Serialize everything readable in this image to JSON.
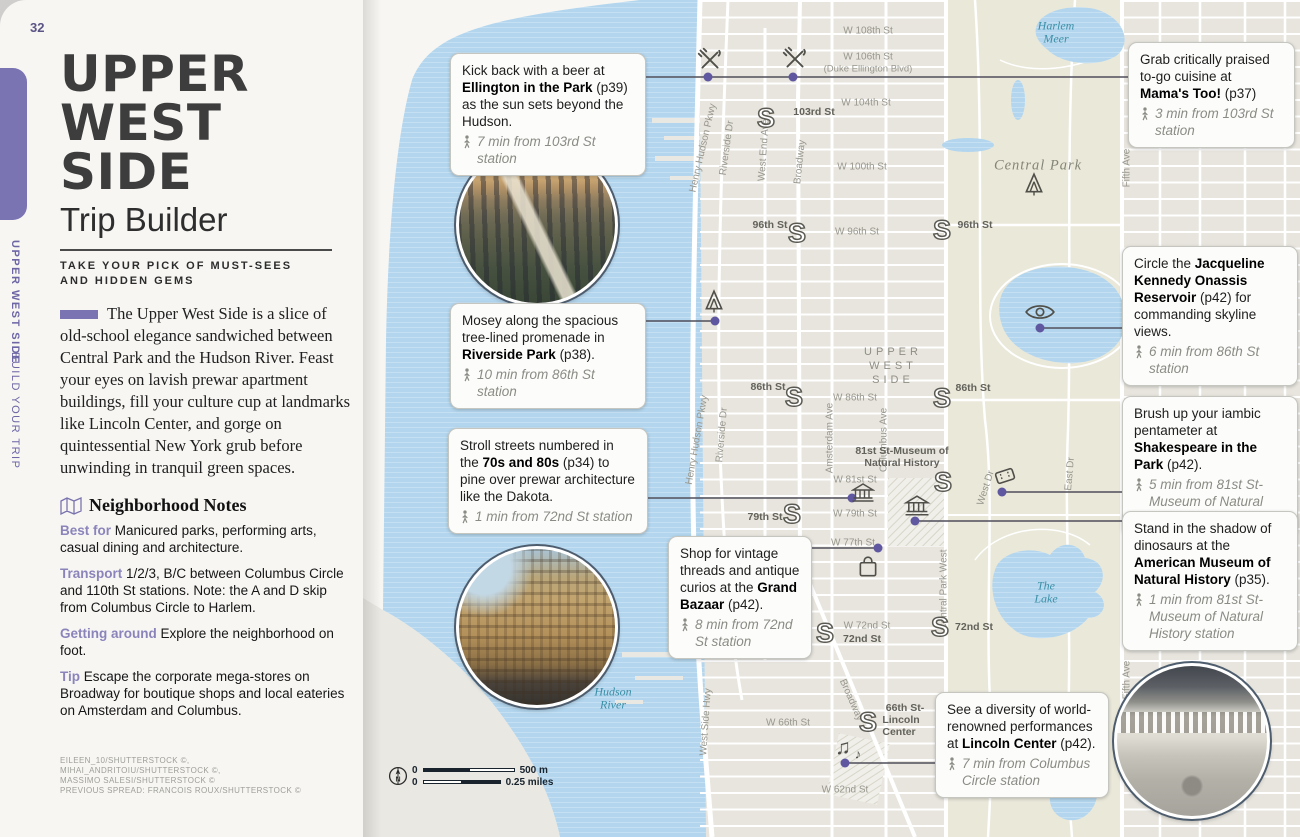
{
  "colors": {
    "accent": "#7b74b3",
    "accent_dark": "#5f58a0",
    "water": "#b3d6ee",
    "land": "#e7e5dd",
    "park": "#eae8d9",
    "teal": "#3b8fa6"
  },
  "icons": {
    "subway": "S",
    "music_note": "♫",
    "music_note_small": "♪",
    "compass_north": "N",
    "restaurant": "crossed-fork-knife",
    "park": "tree",
    "viewpoint": "eye",
    "museum": "classical-building",
    "theater": "ticket",
    "shopping": "bag",
    "walk": "walking-person",
    "notes": "folded-map"
  },
  "page": {
    "number": "32",
    "tab_line1": "UPPER WEST SIDE",
    "tab_line2": "BUILD YOUR TRIP"
  },
  "header": {
    "t1": "UPPER",
    "t2": "WEST",
    "t3": "SIDE",
    "subtitle": "Trip Builder",
    "kicker_l1": "TAKE YOUR PICK OF MUST-SEES",
    "kicker_l2": "AND HIDDEN GEMS"
  },
  "intro": "The Upper West Side is a slice of old-school elegance sandwiched between Central Park and the Hudson River. Feast your eyes on lavish prewar apartment buildings, fill your culture cup at landmarks like Lincoln Center, and gorge on quintessential New York grub before unwinding in tranquil green spaces.",
  "notes": {
    "heading": "Neighborhood Notes",
    "items": [
      {
        "label": "Best for",
        "text": "Manicured parks, performing arts, casual dining and architecture."
      },
      {
        "label": "Transport",
        "text": "1/2/3, B/C between Columbus Circle and 110th St stations. Note: the A and D skip from Columbus Circle to Harlem."
      },
      {
        "label": "Getting around",
        "text": "Explore the neighborhood on foot."
      },
      {
        "label": "Tip",
        "text": "Escape the corporate mega-stores on Broadway for boutique shops and local eateries on Amsterdam and Columbus."
      }
    ]
  },
  "credits": {
    "l1": "EILEEN_10/SHUTTERSTOCK ©, MIHAI_ANDRITOIU/SHUTTERSTOCK ©,",
    "l2": "MASSIMO SALESI/SHUTTERSTOCK ©",
    "l3": "PREVIOUS SPREAD: FRANCOIS ROUX/SHUTTERSTOCK ©"
  },
  "callouts": {
    "ellington": {
      "pre": "Kick back with a beer at ",
      "bold": "Ellington in the Park",
      "post": " (p39) as the sun sets beyond the Hudson.",
      "time": "7 min from 103rd St station"
    },
    "mamas": {
      "pre": "Grab critically praised to-go cuisine at ",
      "bold": "Mama's Too!",
      "post": " (p37)",
      "time": "3 min from 103rd St station"
    },
    "riverside": {
      "pre": "Mosey along the spacious tree-lined promenade in ",
      "bold": "Riverside Park",
      "post": " (p38).",
      "time": "10 min from 86th St station"
    },
    "seventies": {
      "pre": "Stroll streets numbered in the ",
      "bold": "70s and 80s",
      "post": " (p34) to pine over prewar architecture like the Dakota.",
      "time": "1 min from 72nd St station"
    },
    "bazaar": {
      "pre": "Shop for vintage threads and antique curios at the ",
      "bold": "Grand Bazaar",
      "post": " (p42).",
      "time": "8 min from 72nd St station"
    },
    "reservoir": {
      "pre": "Circle the ",
      "bold": "Jacqueline Kennedy Onassis Reservoir",
      "post": " (p42) for commanding skyline views.",
      "time": "6 min from 86th St station"
    },
    "shakespeare": {
      "pre": "Brush up your iambic pentameter at ",
      "bold": "Shakespeare in the Park",
      "post": " (p42).",
      "time": "5 min from 81st St-Museum of Natural History station"
    },
    "amnh": {
      "pre": "Stand in the shadow of dinosaurs at the ",
      "bold": "American Museum of Natural History",
      "post": " (p35).",
      "time": "1 min from 81st St-Museum of Natural History station"
    },
    "lincoln": {
      "pre": "See a diversity of world-renowned performances at ",
      "bold": "Lincoln Center",
      "post": " (p42).",
      "time": "7 min from Columbus Circle station"
    }
  },
  "map": {
    "streets": {
      "w108": "W 108th St",
      "w106": "W 106th St",
      "w106b": "(Duke Ellington Blvd)",
      "w104": "W 104th St",
      "w100": "W 100th St",
      "w96": "W 96th St",
      "w86": "W 86th St",
      "w81": "W 81st St",
      "w79": "W 79th St",
      "w77": "W 77th St",
      "w72": "W 72nd St",
      "w66": "W 66th St",
      "w62": "W 62nd St"
    },
    "avenues": {
      "henry_hudson": "Henry Hudson Pkwy",
      "riverside_dr": "Riverside Dr",
      "west_end": "West End Ave",
      "broadway": "Broadway",
      "amsterdam": "Amsterdam Ave",
      "columbus": "Columbus Ave",
      "cpw": "Central Park West",
      "west_dr": "West Dr",
      "east_dr": "East Dr",
      "fifth": "Fifth Ave",
      "west_side_hwy": "West Side Hwy"
    },
    "stations": {
      "s103": "103rd St",
      "s96": "96th St",
      "s86": "86th St",
      "s81a": "81st St-Museum of",
      "s81b": "Natural History",
      "s79": "79th St",
      "s72w": "W 72nd St",
      "s72": "72nd St",
      "s66a": "66th St-",
      "s66b": "Lincoln",
      "s66c": "Center"
    },
    "areas": {
      "uws1": "UPPER",
      "uws2": "WEST",
      "uws3": "SIDE",
      "central_park": "Central Park"
    },
    "waters": {
      "hudson1": "Hudson",
      "hudson2": "River",
      "meer1": "Harlem",
      "meer2": "Meer",
      "lake1": "The",
      "lake2": "Lake",
      "pond1": "The",
      "pond2": "Pond"
    },
    "scale": {
      "zero": "0",
      "m": "500 m",
      "mi": "0.25 miles"
    }
  }
}
